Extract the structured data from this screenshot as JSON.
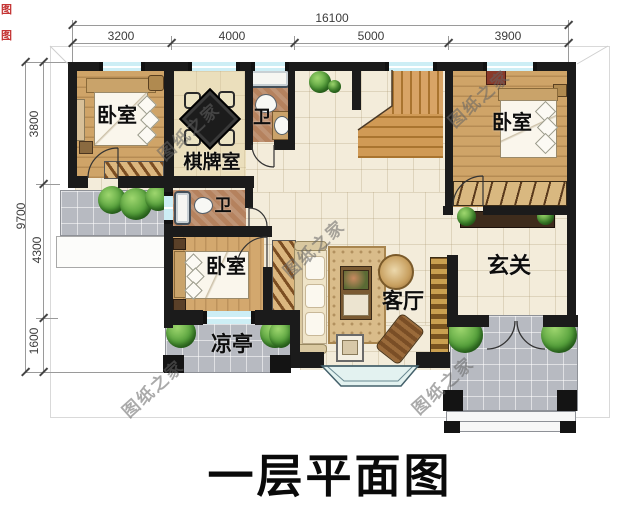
{
  "title": "一层平面图",
  "watermark": {
    "text": "图纸之家"
  },
  "edge_marks": {
    "mark1": "图",
    "mark2": "图"
  },
  "dimensions": {
    "top": {
      "total": "16100",
      "segments": [
        "3200",
        "4000",
        "5000",
        "3900"
      ]
    },
    "left": {
      "total": "9700",
      "segments": [
        "3800",
        "4300",
        "1600"
      ]
    }
  },
  "rooms": {
    "bedroom_top_left": "卧室",
    "chess_room": "棋牌室",
    "bath_top": "卫",
    "bath_mid": "卫",
    "bedroom_mid": "卧室",
    "bedroom_right": "卧室",
    "entry_hall": "玄关",
    "living_room": "客厅",
    "pavilion": "凉亭"
  },
  "colors": {
    "wall": "#1b1b1b",
    "window": "#cdeef5",
    "floor_tile": "#f3ecda",
    "wood": "#cfa468",
    "outdoor_tile": "#b7bac1",
    "greenery": "#4e9a38",
    "title_text": "#0a0a0a"
  }
}
